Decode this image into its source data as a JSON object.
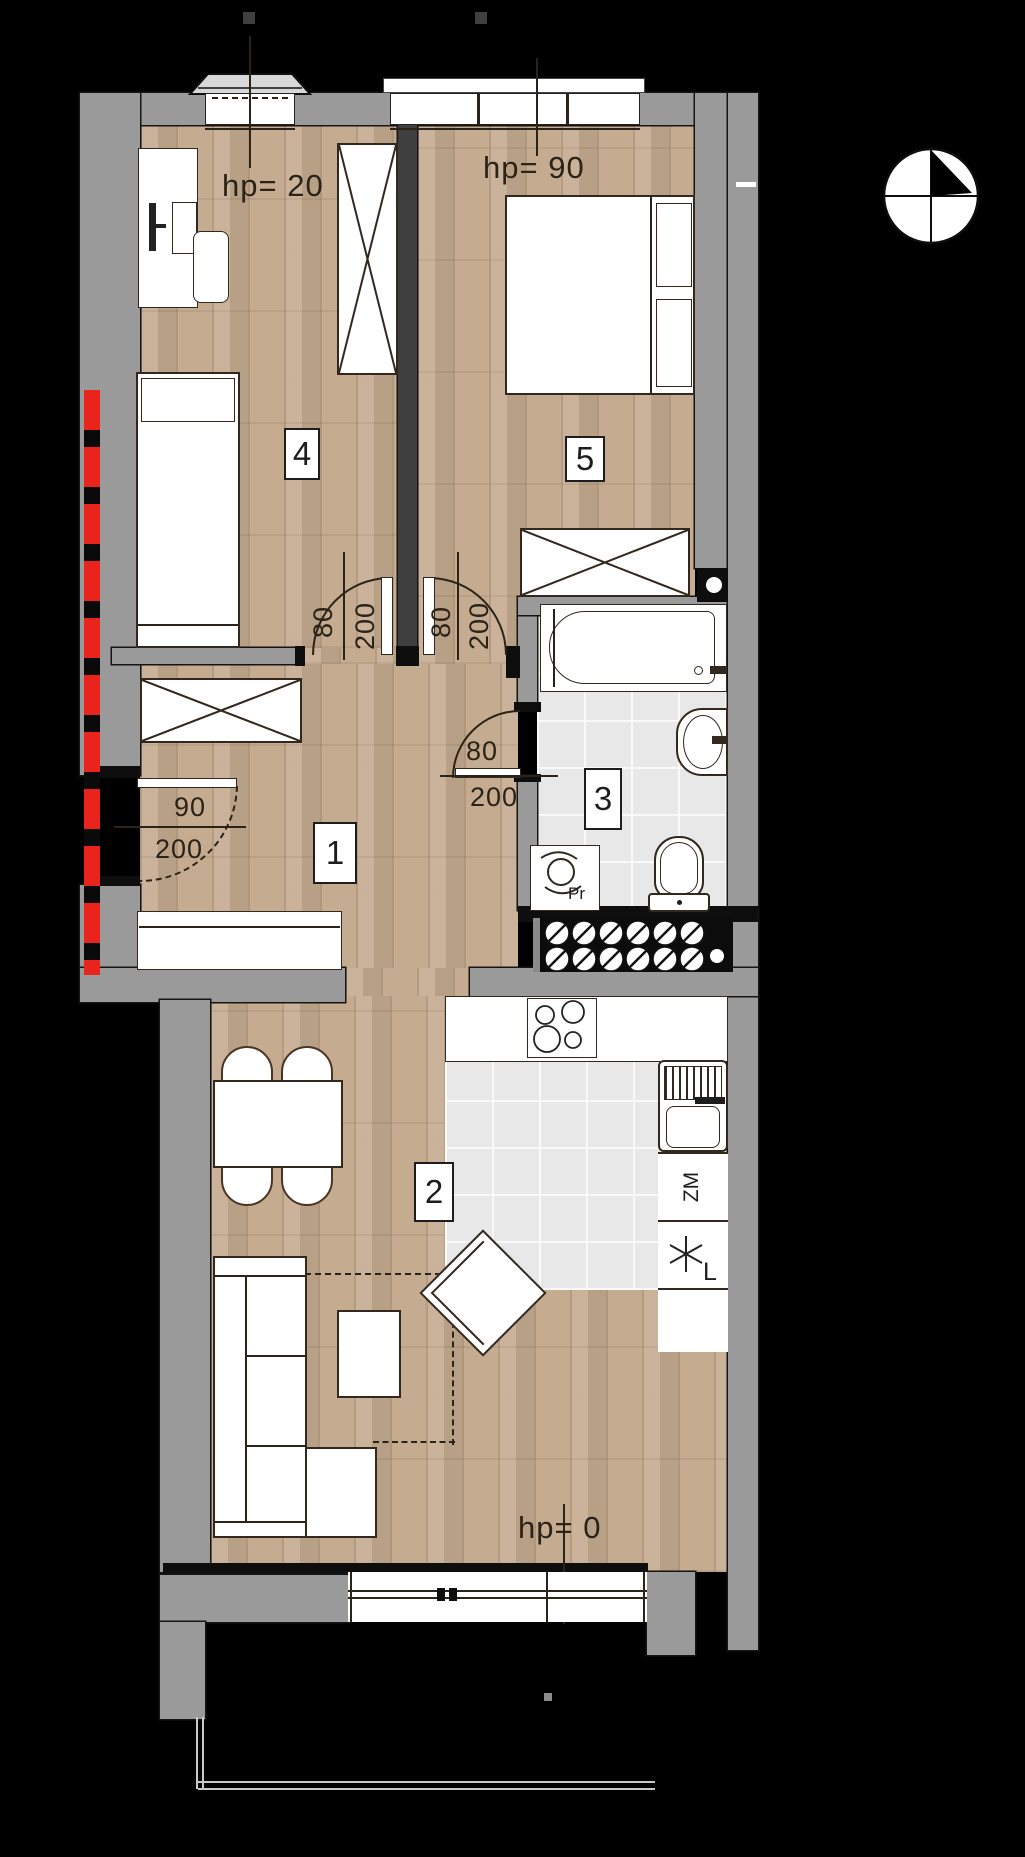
{
  "rooms": {
    "hall": {
      "number": "1"
    },
    "living_kitchen": {
      "number": "2",
      "parapet_label": "hp= 0"
    },
    "bathroom": {
      "number": "3"
    },
    "bedroom_small": {
      "number": "4",
      "parapet_label": "hp= 20"
    },
    "bedroom_large": {
      "number": "5",
      "parapet_label": "hp= 90"
    }
  },
  "doors": {
    "entrance": {
      "width": "90",
      "height": "200"
    },
    "bedroom_small": {
      "width": "80",
      "height": "200"
    },
    "bedroom_large": {
      "width": "80",
      "height": "200"
    },
    "bathroom": {
      "width": "80",
      "height": "200"
    }
  },
  "appliances": {
    "washing_machine": "Pr",
    "dishwasher": "ZM",
    "fridge": "L"
  },
  "colors": {
    "background": "#000000",
    "wall_gray": "#9a9a9a",
    "wall_dark": "#3f3f3f",
    "floor_wood": "#c4aa8e",
    "floor_tile": "#e8e8e8",
    "marker_red": "#e8241c",
    "line_dark": "#2b2317"
  }
}
